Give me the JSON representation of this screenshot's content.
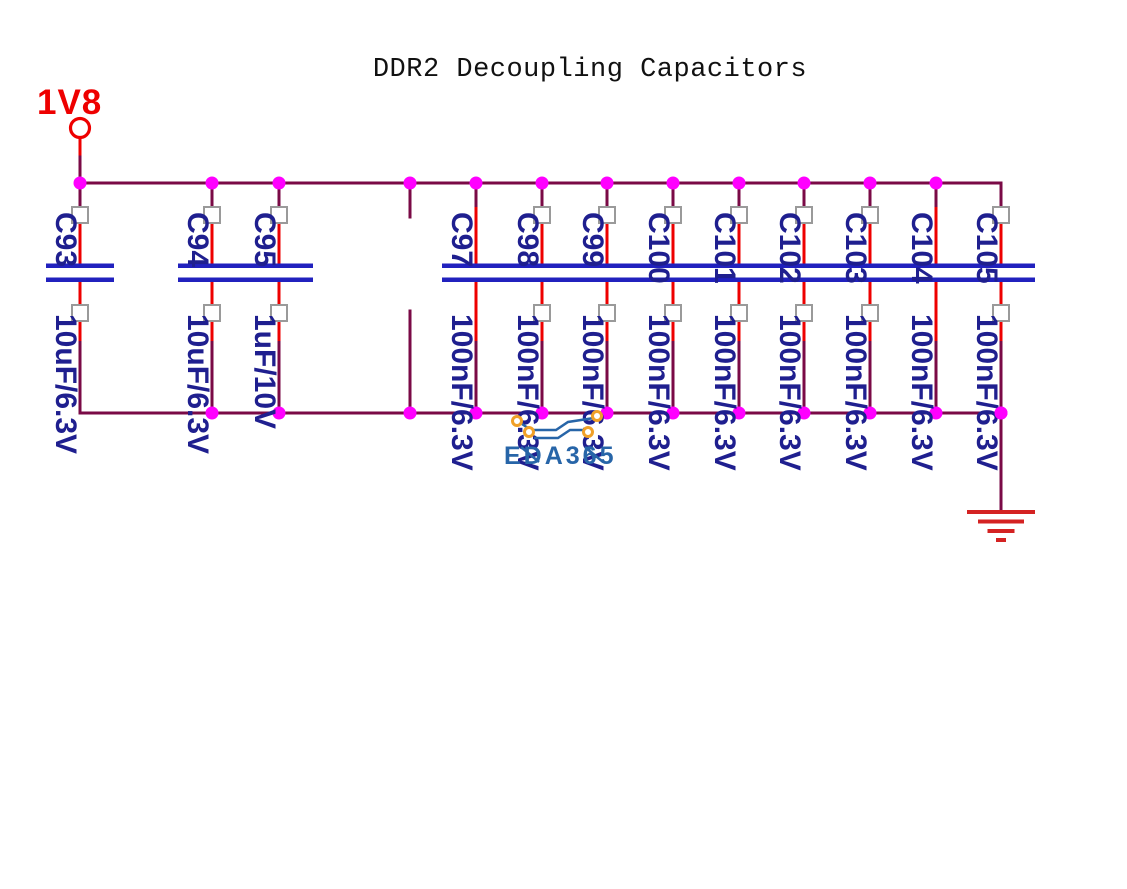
{
  "title": "DDR2 Decoupling Capacitors",
  "power_net": {
    "name": "1V8"
  },
  "watermark": {
    "text": "EDA365"
  },
  "capacitors": [
    {
      "ref": "C93",
      "value": "10uF/6.3V",
      "x": 80,
      "pin_markers": true,
      "dot_top": true,
      "dot_bottom": false
    },
    {
      "ref": "C94",
      "value": "10uF/6.3V",
      "x": 212,
      "pin_markers": true,
      "dot_top": true,
      "dot_bottom": true
    },
    {
      "ref": "C95",
      "value": "1uF/10V",
      "x": 279,
      "pin_markers": true,
      "dot_top": true,
      "dot_bottom": true
    },
    {
      "ref": "C97",
      "value": "100nF/6.3V",
      "x": 476,
      "pin_markers": false,
      "dot_top": true,
      "dot_bottom": true
    },
    {
      "ref": "C98",
      "value": "100nF/6.3V",
      "x": 542,
      "pin_markers": true,
      "dot_top": true,
      "dot_bottom": true
    },
    {
      "ref": "C99",
      "value": "100nF/6.3V",
      "x": 607,
      "pin_markers": true,
      "dot_top": true,
      "dot_bottom": true
    },
    {
      "ref": "C100",
      "value": "100nF/6.3V",
      "x": 673,
      "pin_markers": true,
      "dot_top": true,
      "dot_bottom": true
    },
    {
      "ref": "C101",
      "value": "100nF/6.3V",
      "x": 739,
      "pin_markers": true,
      "dot_top": true,
      "dot_bottom": true
    },
    {
      "ref": "C102",
      "value": "100nF/6.3V",
      "x": 804,
      "pin_markers": true,
      "dot_top": true,
      "dot_bottom": true
    },
    {
      "ref": "C103",
      "value": "100nF/6.3V",
      "x": 870,
      "pin_markers": true,
      "dot_top": true,
      "dot_bottom": true
    },
    {
      "ref": "C104",
      "value": "100nF/6.3V",
      "x": 936,
      "pin_markers": false,
      "dot_top": true,
      "dot_bottom": true
    },
    {
      "ref": "C105",
      "value": "100nF/6.3V",
      "x": 1001,
      "pin_markers": true,
      "dot_top": false,
      "dot_bottom": true
    }
  ],
  "unpopulated_stub": {
    "x": 410,
    "dot_top": true,
    "dot_bottom": true
  },
  "colors": {
    "bus_wire": "#7a0a46",
    "pin_wire": "#ee0000",
    "junction": "#ff00ff",
    "capacitor_plate": "#2121be",
    "designator_text": "#1f1f8f",
    "net_label": "#ee0000",
    "ground_symbol": "#d42222",
    "pin_marker_border": "#9a9a9a",
    "watermark_blue": "#2765a8",
    "watermark_orange": "#f0a028",
    "title_text": "#111111"
  }
}
